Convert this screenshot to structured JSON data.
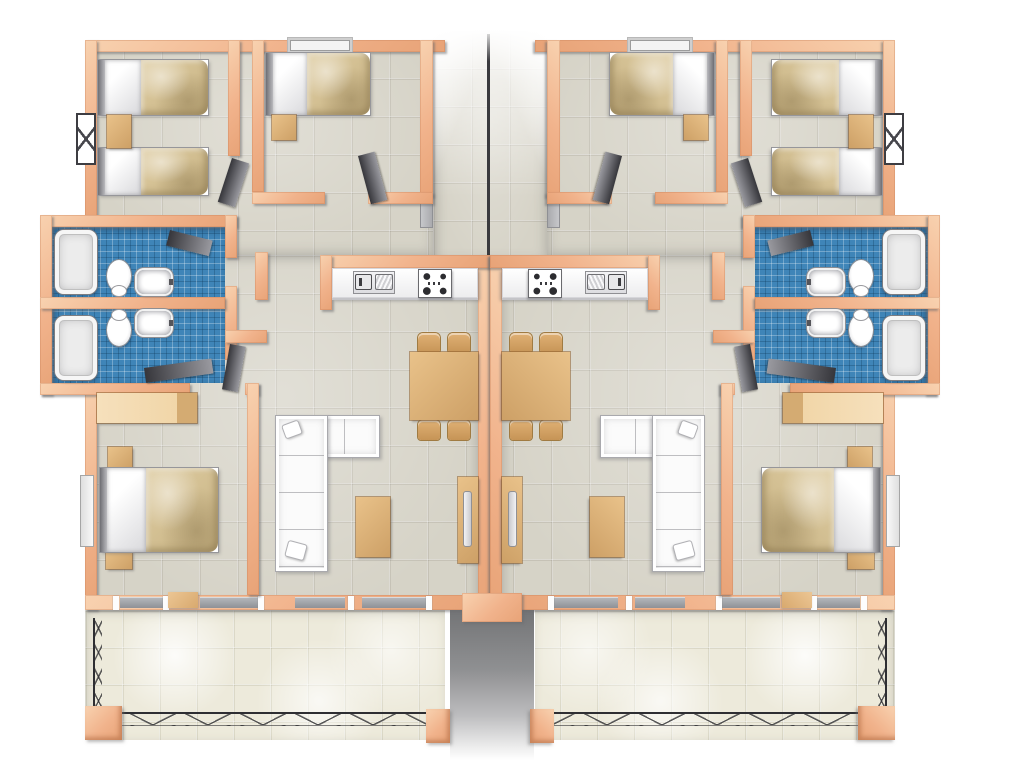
{
  "scene": {
    "title": "3D rendered floor plan of two mirrored apartment units with balconies and a central stairwell",
    "units": [
      {
        "id": "apartment-left",
        "mirrored": false
      },
      {
        "id": "apartment-right",
        "mirrored": true
      }
    ],
    "corridor_label": "Central stairwell corridor",
    "balcony_gap_label": "Gap between balconies"
  },
  "unit": {
    "rooms": {
      "bedroom_twin": {
        "label": "Twin bedroom",
        "furniture": [
          "twin bed",
          "twin bed",
          "nightstand",
          "window"
        ]
      },
      "bedroom_single": {
        "label": "Single bedroom",
        "furniture": [
          "single bed",
          "nightstand",
          "window"
        ]
      },
      "bathroom_a": {
        "label": "Bathroom 1",
        "furniture": [
          "bathtub",
          "toilet",
          "sink"
        ]
      },
      "bathroom_b": {
        "label": "Bathroom 2",
        "furniture": [
          "bathtub",
          "toilet",
          "sink"
        ]
      },
      "bedroom_double": {
        "label": "Double bedroom",
        "furniture": [
          "double bed",
          "wardrobe",
          "nightstand",
          "nightstand",
          "window"
        ]
      },
      "living_dining": {
        "label": "Living / dining room",
        "furniture": [
          "corner sofa",
          "coffee table",
          "TV console",
          "dining table",
          "4 chairs"
        ]
      },
      "kitchen": {
        "label": "Kitchen nook",
        "furniture": [
          "counter",
          "double sink",
          "stove"
        ]
      },
      "balcony": {
        "label": "Balcony terrace",
        "furniture": [
          "railing"
        ]
      }
    }
  },
  "palette": {
    "wall_peach": "#f1b38c",
    "wall_highlight": "#f8d2b0",
    "floor_beige": "#d6d3c7",
    "bathroom_blue": "#3f85b8",
    "balcony_cream": "#edeadb",
    "wood_tan": "#d9a76a",
    "wardrobe_light": "#f1d6a8",
    "blanket_tan": "#d2bf96",
    "sofa_white": "#fbfbfb",
    "door_dark": "#36363b",
    "railing_dark": "#2e2e32",
    "background": "#ffffff"
  }
}
